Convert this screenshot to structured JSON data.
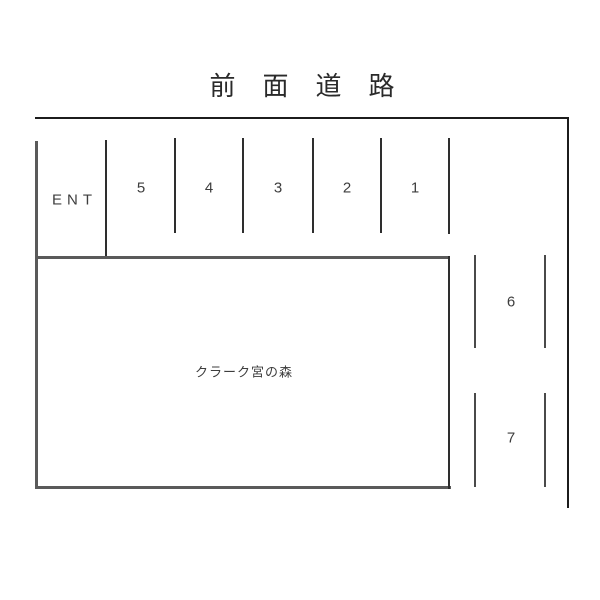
{
  "road": {
    "label": "前面道路"
  },
  "entrance": {
    "label": "ENT"
  },
  "building": {
    "label": "クラーク宮の森"
  },
  "spaces": {
    "top_row": [
      {
        "number": "5"
      },
      {
        "number": "4"
      },
      {
        "number": "3"
      },
      {
        "number": "2"
      },
      {
        "number": "1"
      }
    ],
    "right_column": [
      {
        "number": "6"
      },
      {
        "number": "7"
      }
    ]
  },
  "colors": {
    "boundary_line": "#1c1c1c",
    "building_line": "#5a5a5a",
    "text": "#3d3d3d",
    "background": "#ffffff"
  }
}
